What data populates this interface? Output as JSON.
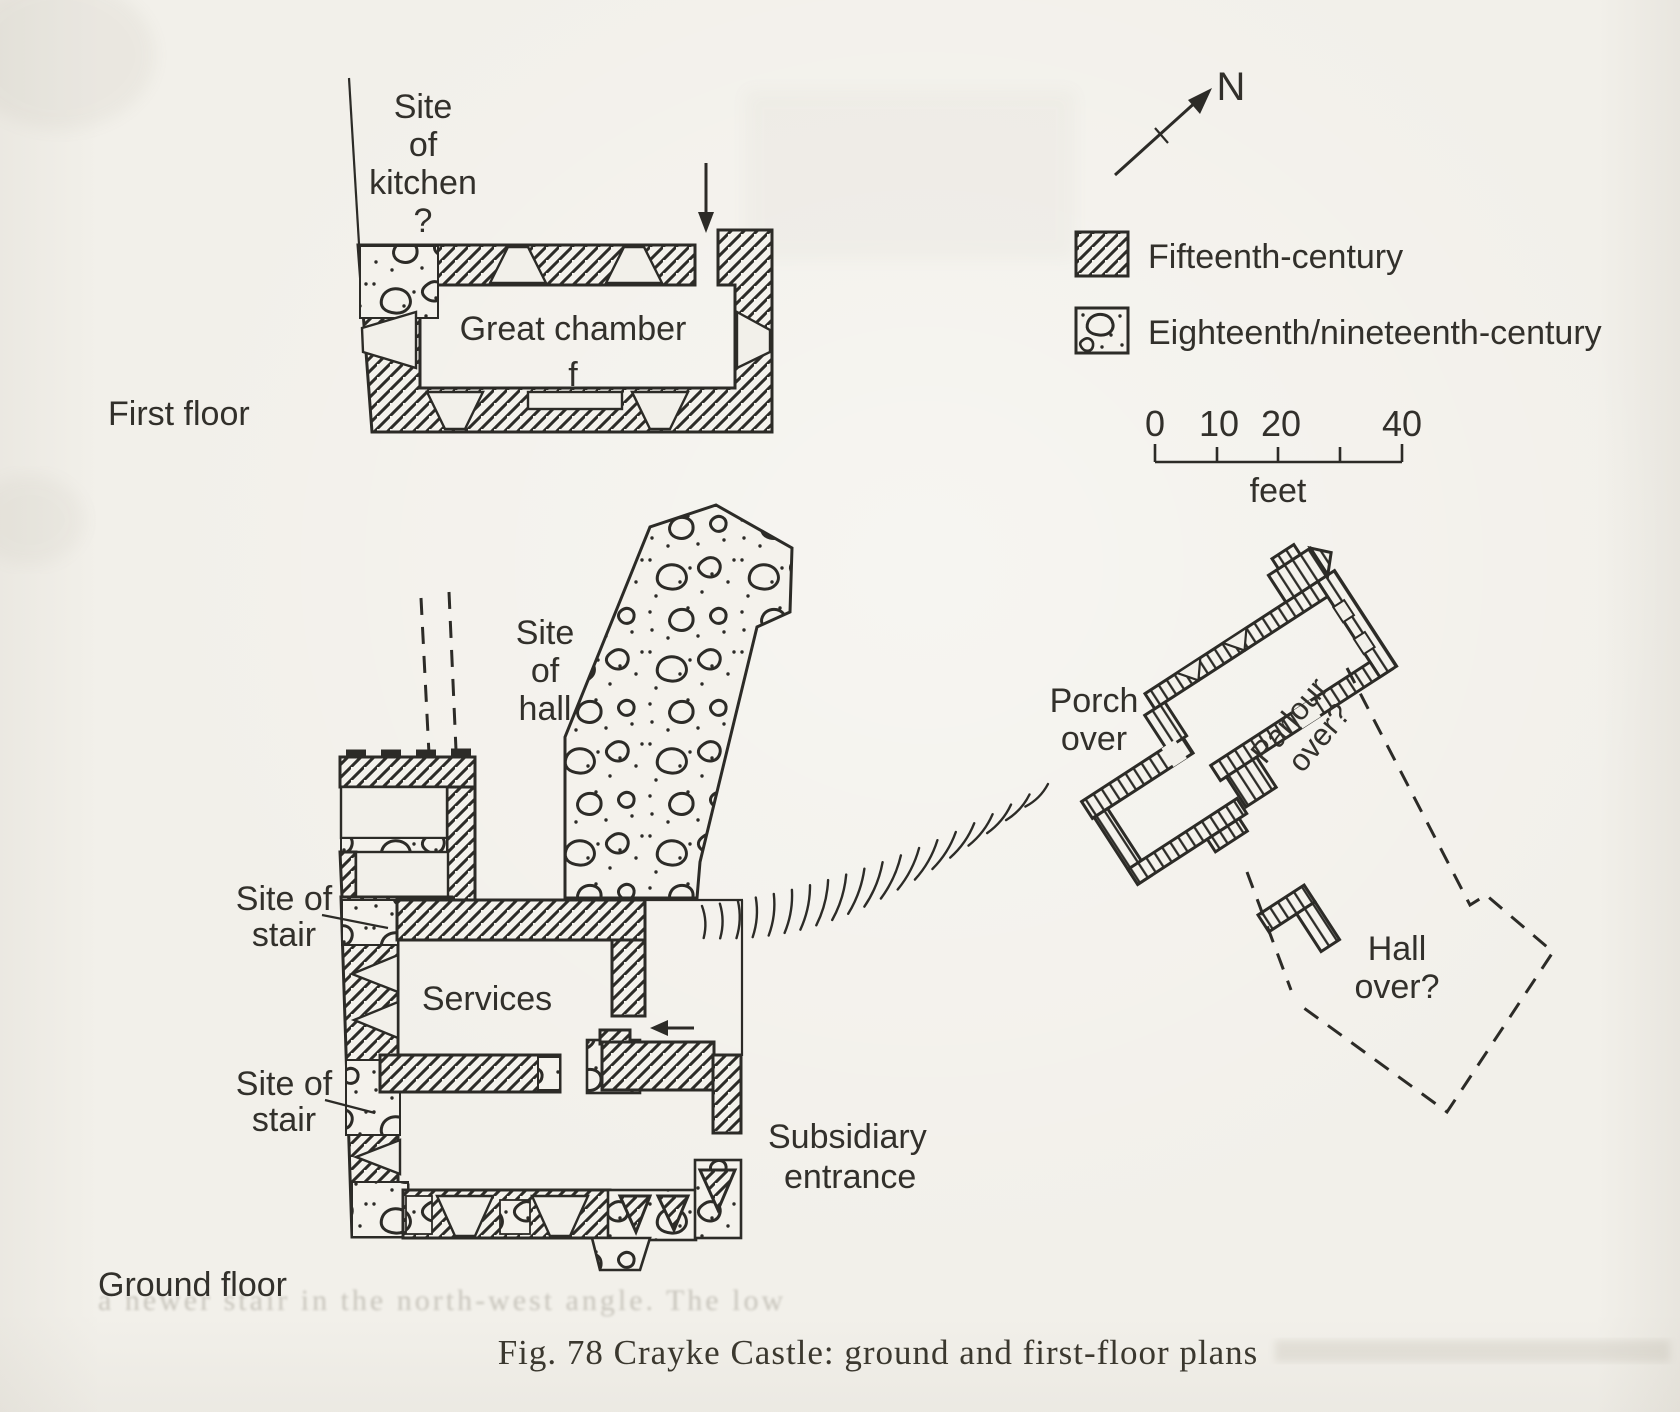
{
  "page": {
    "caption": "Fig. 78 Crayke Castle: ground and first-floor plans"
  },
  "first_floor": {
    "floor_label": "First floor",
    "kitchen_label": {
      "line1": "Site",
      "line2": "of",
      "line3": "kitchen",
      "line4": "?"
    },
    "room_label": "Great chamber",
    "fireplace_label": "f"
  },
  "ground_floor": {
    "floor_label": "Ground floor",
    "hall_site_label": {
      "line1": "Site",
      "line2": "of",
      "line3": "hall"
    },
    "stair_upper_label": {
      "line1": "Site of",
      "line2": "stair"
    },
    "stair_lower_label": {
      "line1": "Site of",
      "line2": "stair"
    },
    "room_label": "Services",
    "entrance_label": {
      "line1": "Subsidiary",
      "line2": "entrance"
    }
  },
  "east_range": {
    "porch_label": {
      "line1": "Porch",
      "line2": "over"
    },
    "parlour_label": {
      "line1": "Parlour",
      "line2": "over?"
    },
    "hall_label": {
      "line1": "Hall",
      "line2": "over?"
    }
  },
  "legend": {
    "north_label": "N",
    "items": [
      {
        "name": "fifteenth-century",
        "label": "Fifteenth-century"
      },
      {
        "name": "eighteenth-nineteenth-century",
        "label": "Eighteenth/nineteenth-century"
      }
    ]
  },
  "scale_bar": {
    "tick_labels": [
      "0",
      "10",
      "20",
      "40"
    ],
    "unit_label": "feet"
  },
  "bleed_through": {
    "line1": "a newer stair in the north-west angle. The low"
  }
}
